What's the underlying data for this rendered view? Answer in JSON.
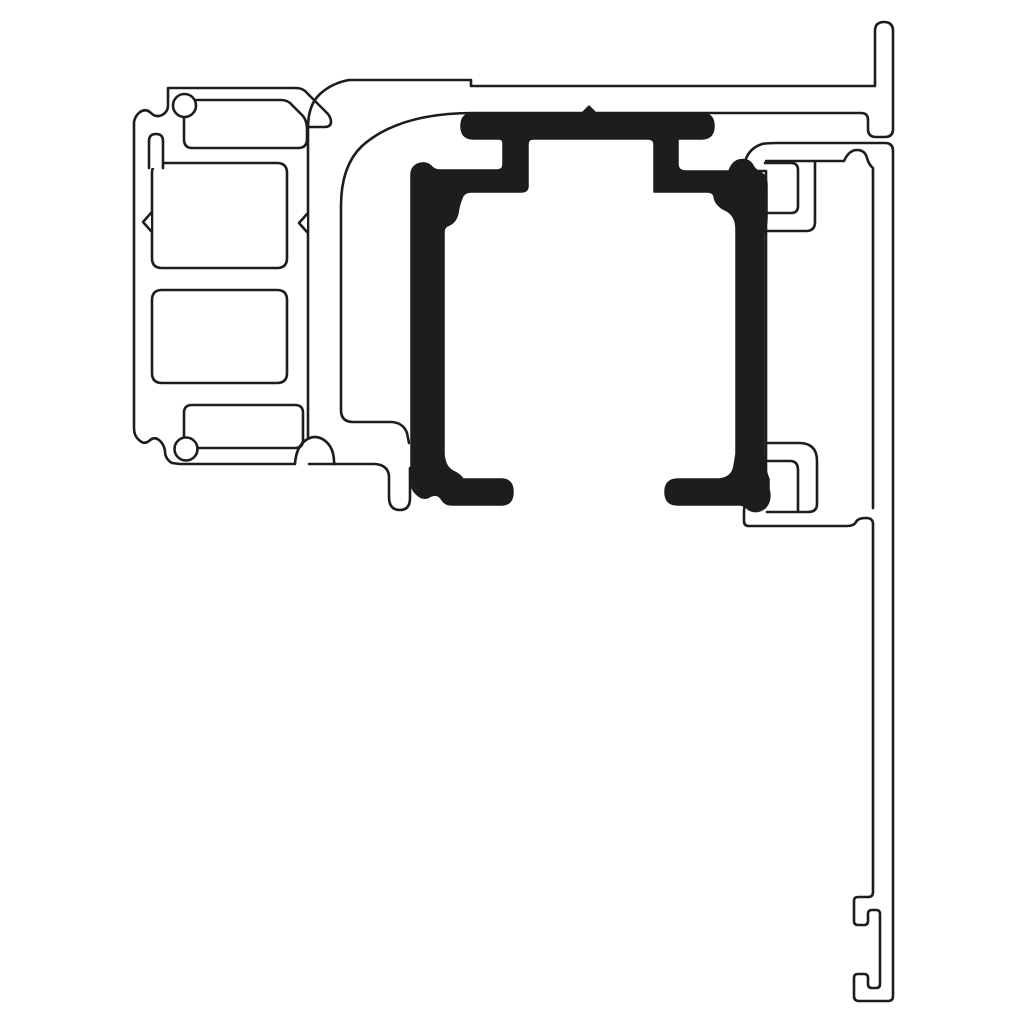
{
  "page": {
    "background": "#ffffff",
    "aria_label": "Technical cross-section drawing of an aluminium sliding-door head frame assembly with a solid black roller-track insert"
  },
  "drawing": {
    "title": "Aluminium profile cross-section",
    "canvas": {
      "width": 1024,
      "height": 1024
    },
    "style": {
      "line_color": "#1d1d1f",
      "line_width": 2.6,
      "insert_line_width": 1.5,
      "white": "#ffffff",
      "background": "#ffffff"
    },
    "shapes": [
      {
        "name": "head-profile-outline",
        "d": "M 308,437 L 308,128 Q 308,105 320,94 Q 332,83 349,80 L 471,80 L 471,86 L 875,86 L 875,31 Q 875,22 884,22 Q 893,22 893,31 L 893,129 Q 893,137 885,137 L 876,137 Q 868,137 868,129 L 868,120 Q 868,113 861,113 L 473,113 Q 399,113 362,146 Q 341,166 341,206 L 341,410 Q 341,422 353,422 L 390,422 Q 403,422 407,433 L 409,443",
        "fill": "none",
        "stroke": "line",
        "width": "normal"
      },
      {
        "name": "head-profile-pocket",
        "d": "M 309,464 L 375,464 Q 388,465 389,476 L 389,497 Q 389,510 400,510 Q 410,510 410,498 L 410,468",
        "fill": "none",
        "stroke": "line",
        "width": "normal"
      },
      {
        "name": "left-profile-outline",
        "d": "M 296,88 L 168,88 L 168,105 Q 168,112 162,115 Q 156,118 151,113 Q 146,108 140,112 Q 135,116 134,122 L 134,428 Q 134,436 139,440 Q 144,445 149,441 Q 154,436 159,440 Q 164,444 165,451 Q 165,459 172,463 L 180,464 L 295,464 Q 296,447 306,440 Q 315,434 324,440 Q 334,447 334,462 L 335,464",
        "fill": "none",
        "stroke": "line",
        "width": "normal"
      },
      {
        "name": "left-profile-top-hook",
        "d": "M 296,88 Q 303,88 307,93 L 328,114 Q 331,118 331,122 Q 331,127 324,127 L 308,127",
        "fill": "none",
        "stroke": "line",
        "width": "normal"
      },
      {
        "name": "left-profile-top-slot",
        "d": "M 196,100 L 281,100 Q 288,100 292,105 L 303,116 Q 307,121 307,129 L 307,139 Q 307,148 298,148 L 192,148 Q 184,148 184,139 L 184,115",
        "fill": "none",
        "stroke": "line",
        "width": "normal"
      },
      {
        "name": "left-profile-top-slot-eye",
        "d": "M 173,105.5 A 11.5,11.5 0 1 0 196,105.5 A 11.5,11.5 0 1 0 173,105.5 Z",
        "fill": "white",
        "stroke": "line",
        "width": "normal"
      },
      {
        "name": "left-profile-chamber-upper",
        "d": "M 162,163 L 277,163 Q 287,163 287,173 L 287,258 Q 287,268 277,268 L 162,268 Q 152,268 152,258 L 152,173 Q 152,163 162,163 Z",
        "fill": "none",
        "stroke": "line",
        "width": "normal"
      },
      {
        "name": "left-profile-chamber-upper-stub",
        "d": "M 149,168 L 149,141 Q 149,134 156,134 Q 163,134 163,141 L 163,168",
        "fill": "white",
        "stroke": "line",
        "width": "normal"
      },
      {
        "name": "left-profile-notch-left",
        "d": "M 151,213 L 143,222 L 151,231",
        "fill": "white",
        "stroke": "line",
        "width": "normal"
      },
      {
        "name": "left-profile-notch-right",
        "d": "M 307,214 L 299,223 L 307,232",
        "fill": "white",
        "stroke": "line",
        "width": "normal"
      },
      {
        "name": "left-profile-chamber-lower",
        "d": "M 162,290 L 277,290 Q 287,290 287,300 L 287,373 Q 287,383 277,383 L 162,383 Q 152,383 152,373 L 152,300 Q 152,290 162,290 Z",
        "fill": "none",
        "stroke": "line",
        "width": "normal"
      },
      {
        "name": "left-profile-bottom-slot",
        "d": "M 192,405 L 295,405 Q 303,405 303,413 L 303,440 Q 303,448 295,448 L 192,448 Q 184,448 184,440 L 184,413 Q 184,405 192,405 Z",
        "fill": "none",
        "stroke": "line",
        "width": "normal"
      },
      {
        "name": "left-profile-bottom-slot-eye",
        "d": "M 174.5,449 A 11.5,11.5 0 1 0 197.5,449 A 11.5,11.5 0 1 0 174.5,449 Z",
        "fill": "white",
        "stroke": "line",
        "width": "normal"
      },
      {
        "name": "frame-profile-outline",
        "d": "M 744,171 Q 744,150 762,144 Q 768,143 777,143 L 885,143 Q 893,143 893,151 L 893,996 Q 893,1001 888,1001 L 859,1001 Q 854,1001 854,996 L 854,978 Q 854,974 858,974 L 864,974 Q 868,974 868,978 L 868,984 Q 868,988 872,988 L 876,988 Q 880,988 880,984 L 880,914 Q 880,910 876,910 L 872,910 Q 868,910 868,914 L 868,921 Q 868,925 864,925 L 858,925 Q 854,925 854,921 L 854,901 Q 854,897 858,897 L 868,897 Q 873,897 873,892 L 873,524 Q 873,518 866,518 Q 858,518 856,522 Q 854,526 847,526 L 749,526 Q 744,526 744,521 L 744,511 Q 744,502 753,500 L 760,499 Q 766,498 766,492 L 766,171 Z",
        "fill": "none",
        "stroke": "line",
        "width": "normal"
      },
      {
        "name": "frame-profile-inner-edge",
        "d": "M 766,161 L 844,161 Q 849,150 857,150 Q 865,150 867,158 Q 869,165 873,168 L 873,508",
        "fill": "none",
        "stroke": "line",
        "width": "normal"
      },
      {
        "name": "frame-clip-top-inner",
        "d": "M 765,163 L 791,163 Q 798,163 798,170 L 798,206 Q 798,213 791,213 L 765,213",
        "fill": "none",
        "stroke": "line",
        "width": "normal"
      },
      {
        "name": "frame-clip-top-outer",
        "d": "M 765,231 L 806,231 Q 815,231 815,222 L 815,163",
        "fill": "none",
        "stroke": "line",
        "width": "normal"
      },
      {
        "name": "frame-clip-bottom-outer",
        "d": "M 767,443 L 799,443 Q 817,443 817,461 L 817,504 Q 817,512 808,512 L 767,512",
        "fill": "none",
        "stroke": "line",
        "width": "normal"
      },
      {
        "name": "frame-clip-bottom-inner",
        "d": "M 767,461 L 790,461 Q 798,461 798,470 L 798,511",
        "fill": "none",
        "stroke": "line",
        "width": "normal"
      },
      {
        "name": "track-insert",
        "d": "M 461,126 Q 461,113 474,113 L 582,113 L 589,106 L 596,113 L 701,113 Q 714,113 714,126 Q 714,139 701,139 L 678,139 L 678,164 Q 678,171 686,171 L 729,171 Q 732,162 739,160 Q 748,158 752,164 Q 755,170 760,172 L 764,175 Q 767,178 767,185 L 767,218 Q 767,226 764,230 L 764,450 Q 764,468 769,479 L 769,489 Q 772,501 765,508 Q 757,514 749,510 Q 745,506 741,505 L 678,505 Q 665,505 665,492 Q 665,479 678,479 L 719,479 Q 732,478 734,466 L 736,454 L 736,229 Q 736,215 725,210 Q 715,205 714,196 Q 713,192 707,192 L 654,192 L 654,144 Q 654,139 648,139 L 533,139 Q 528,139 528,144 L 528,186 Q 528,192 521,192 L 471,192 Q 464,192 462,198 Q 459,205 458,213 Q 456,223 447,226 Q 444,228 444,232 L 444,454 Q 445,467 453,471 Q 461,475 463,479 L 501,479 Q 513,479 513,492 Q 513,505 501,505 L 452,505 Q 445,505 442,500 Q 438,493 431,496 Q 425,500 420,497 Q 414,493 412,488 L 411,478 L 411,175 Q 411,167 418,164 Q 426,161 431,166 Q 434,170 440,170 L 497,170 Q 503,170 503,164 L 503,143 Q 503,139 499,139 L 474,139 Q 461,139 461,126 Z",
        "fill": "line",
        "stroke": "line",
        "width": "insert"
      }
    ]
  }
}
